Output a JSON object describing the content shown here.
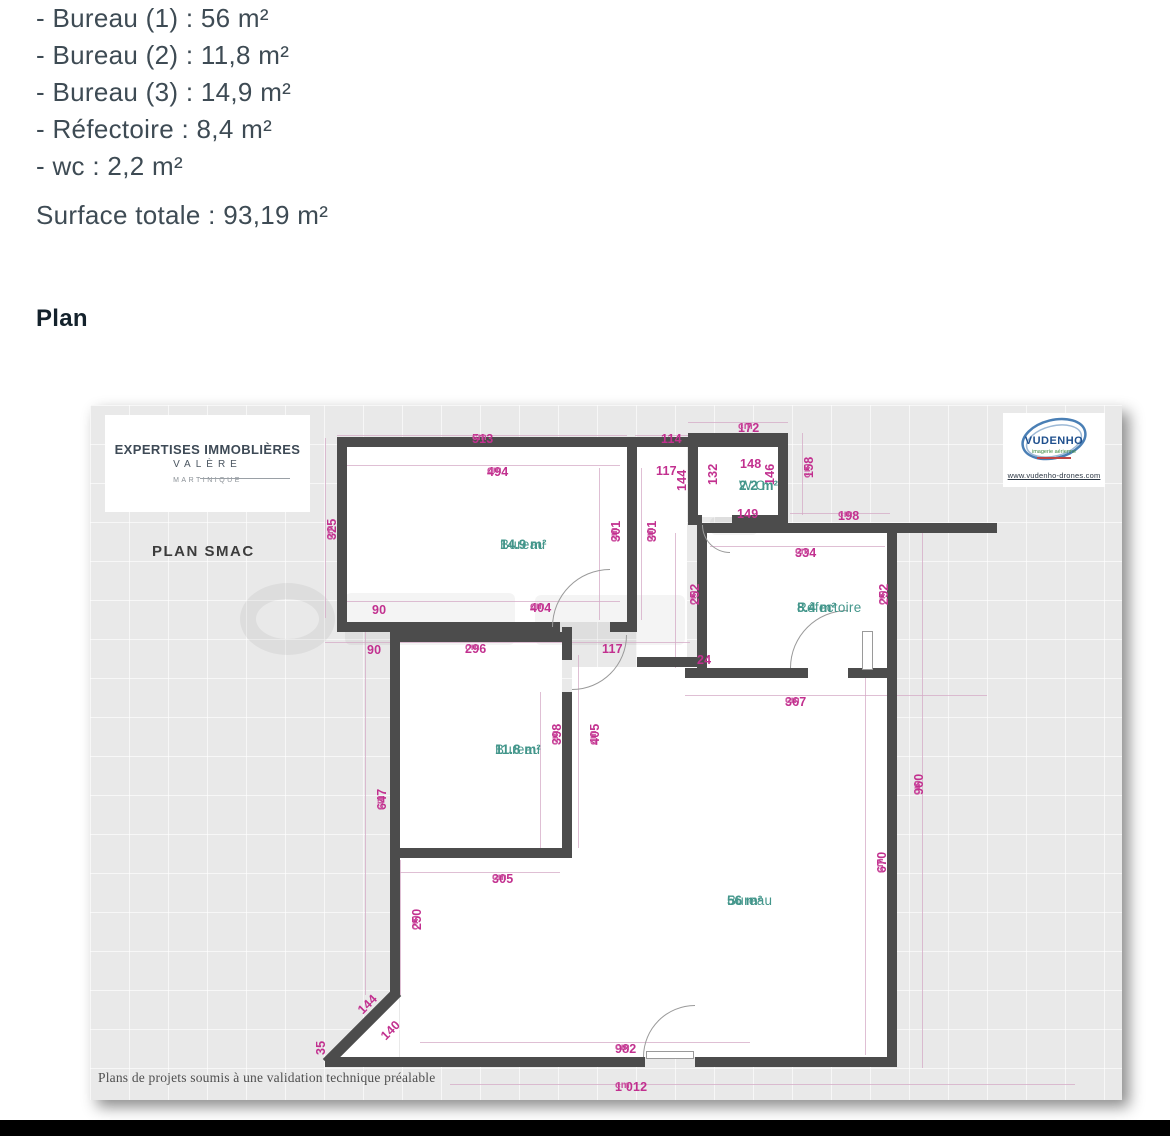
{
  "document": {
    "area_list": [
      "- Bureau (1) : 56 m²",
      "- Bureau (2) : 11,8 m²",
      "- Bureau (3) : 14,9 m²",
      "- Réfectoire : 8,4 m²",
      "- wc : 2,2 m²"
    ],
    "surface_total": "Surface totale : 93,19 m²",
    "plan_heading": "Plan"
  },
  "plan": {
    "agency": {
      "line1": "EXPERTISES IMMOBLIÈRES",
      "line2": "VALÈRE",
      "line3": "MARTINIQUE"
    },
    "plan_title": "PLAN SMAC",
    "vendor": {
      "name": "VUDENHO",
      "tagline": "imagerie aérienne",
      "url": "www.vudenho-drones.com"
    },
    "ceiling_note": "H. sous plafond  280cm",
    "footer_note": "Plans de projets soumis à une validation technique préalable",
    "colors": {
      "dimension": "#c2308f",
      "room": "#43968b",
      "wall": "#4c4c4c"
    },
    "white_areas": [
      {
        "x": 257,
        "y": 42,
        "w": 280,
        "h": 175
      },
      {
        "x": 547,
        "y": 42,
        "w": 50,
        "h": 210
      },
      {
        "x": 608,
        "y": 36,
        "w": 80,
        "h": 76
      },
      {
        "x": 617,
        "y": 128,
        "w": 180,
        "h": 137
      },
      {
        "x": 310,
        "y": 237,
        "w": 162,
        "h": 216
      },
      {
        "x": 310,
        "y": 453,
        "w": 180,
        "h": 199
      },
      {
        "x": 482,
        "y": 262,
        "w": 315,
        "h": 390
      },
      {
        "x": 547,
        "y": 252,
        "w": 60,
        "h": 20
      }
    ],
    "triangle": {
      "x": 243,
      "y": 587,
      "w": 66,
      "h": 67
    },
    "watermarks": [
      {
        "x": 150,
        "y": 178,
        "w": 95,
        "h": 72,
        "ring": true
      },
      {
        "x": 255,
        "y": 188,
        "w": 170,
        "h": 52,
        "ring": false
      },
      {
        "x": 445,
        "y": 190,
        "w": 150,
        "h": 50,
        "ring": false
      },
      {
        "x": 620,
        "y": 112,
        "w": 48,
        "h": 18,
        "ring": false
      }
    ],
    "lines": [
      {
        "x": 247,
        "y": 30,
        "w": 290,
        "h": 1
      },
      {
        "x": 545,
        "y": 30,
        "w": 53,
        "h": 1
      },
      {
        "x": 598,
        "y": 17,
        "w": 100,
        "h": 1
      },
      {
        "x": 255,
        "y": 60,
        "w": 275,
        "h": 1
      },
      {
        "x": 255,
        "y": 196,
        "w": 275,
        "h": 1
      },
      {
        "x": 235,
        "y": 237,
        "w": 365,
        "h": 1
      },
      {
        "x": 620,
        "y": 141,
        "w": 175,
        "h": 1
      },
      {
        "x": 700,
        "y": 108,
        "w": 100,
        "h": 1
      },
      {
        "x": 595,
        "y": 290,
        "w": 302,
        "h": 1
      },
      {
        "x": 300,
        "y": 467,
        "w": 170,
        "h": 1
      },
      {
        "x": 330,
        "y": 637,
        "w": 330,
        "h": 1
      },
      {
        "x": 360,
        "y": 679,
        "w": 625,
        "h": 1
      },
      {
        "x": 235,
        "y": 33,
        "w": 1,
        "h": 180
      },
      {
        "x": 509,
        "y": 63,
        "w": 1,
        "h": 152
      },
      {
        "x": 551,
        "y": 63,
        "w": 1,
        "h": 152
      },
      {
        "x": 712,
        "y": 28,
        "w": 1,
        "h": 82
      },
      {
        "x": 585,
        "y": 128,
        "w": 1,
        "h": 135
      },
      {
        "x": 800,
        "y": 128,
        "w": 1,
        "h": 135
      },
      {
        "x": 450,
        "y": 287,
        "w": 1,
        "h": 156
      },
      {
        "x": 488,
        "y": 250,
        "w": 1,
        "h": 193
      },
      {
        "x": 275,
        "y": 220,
        "w": 1,
        "h": 370
      },
      {
        "x": 310,
        "y": 455,
        "w": 1,
        "h": 135
      },
      {
        "x": 832,
        "y": 118,
        "w": 1,
        "h": 545
      },
      {
        "x": 775,
        "y": 255,
        "w": 1,
        "h": 395
      }
    ],
    "walls": [
      {
        "x": 247,
        "y": 32,
        "w": 451,
        "h": 10
      },
      {
        "x": 598,
        "y": 28,
        "w": 100,
        "h": 10
      },
      {
        "x": 598,
        "y": 28,
        "w": 10,
        "h": 92
      },
      {
        "x": 688,
        "y": 28,
        "w": 10,
        "h": 92
      },
      {
        "x": 598,
        "y": 110,
        "w": 14,
        "h": 10
      },
      {
        "x": 642,
        "y": 110,
        "w": 56,
        "h": 10
      },
      {
        "x": 247,
        "y": 32,
        "w": 10,
        "h": 195
      },
      {
        "x": 247,
        "y": 217,
        "w": 223,
        "h": 10
      },
      {
        "x": 520,
        "y": 217,
        "w": 27,
        "h": 10
      },
      {
        "x": 537,
        "y": 42,
        "w": 10,
        "h": 185
      },
      {
        "x": 607,
        "y": 118,
        "w": 300,
        "h": 10
      },
      {
        "x": 607,
        "y": 118,
        "w": 10,
        "h": 155
      },
      {
        "x": 595,
        "y": 263,
        "w": 123,
        "h": 10
      },
      {
        "x": 758,
        "y": 263,
        "w": 49,
        "h": 10
      },
      {
        "x": 797,
        "y": 118,
        "w": 10,
        "h": 544
      },
      {
        "x": 300,
        "y": 227,
        "w": 172,
        "h": 10
      },
      {
        "x": 472,
        "y": 222,
        "w": 10,
        "h": 33
      },
      {
        "x": 547,
        "y": 252,
        "w": 70,
        "h": 10
      },
      {
        "x": 472,
        "y": 287,
        "w": 10,
        "h": 156
      },
      {
        "x": 300,
        "y": 443,
        "w": 182,
        "h": 10
      },
      {
        "x": 300,
        "y": 217,
        "w": 10,
        "h": 373
      },
      {
        "x": 222,
        "y": 617,
        "w": 100,
        "h": 11,
        "r": -45
      },
      {
        "x": 235,
        "y": 652,
        "w": 320,
        "h": 10
      },
      {
        "x": 605,
        "y": 652,
        "w": 192,
        "h": 10
      }
    ],
    "doors": [
      {
        "x": 462,
        "y": 164,
        "w": 58,
        "h": 58,
        "c": "tl"
      },
      {
        "x": 482,
        "y": 230,
        "w": 55,
        "h": 55,
        "c": "br"
      },
      {
        "x": 700,
        "y": 205,
        "w": 58,
        "h": 58,
        "c": "tl"
      },
      {
        "x": 612,
        "y": 120,
        "w": 28,
        "h": 28,
        "c": "bl"
      },
      {
        "x": 553,
        "y": 600,
        "w": 52,
        "h": 52,
        "c": "tl"
      }
    ],
    "leaves": [
      {
        "x": 772,
        "y": 226,
        "w": 11,
        "h": 39
      },
      {
        "x": 556,
        "y": 646,
        "w": 48,
        "h": 8
      }
    ],
    "dims": [
      {
        "t": "513",
        "u": "cm",
        "x": 382,
        "y": 27,
        "r": 0
      },
      {
        "t": "114",
        "u": "",
        "x": 571,
        "y": 27,
        "r": 0
      },
      {
        "t": "172",
        "u": "cm",
        "x": 648,
        "y": 16,
        "r": 0
      },
      {
        "t": "494",
        "u": "cm",
        "x": 397,
        "y": 60,
        "r": 0
      },
      {
        "t": "117",
        "u": "",
        "x": 566,
        "y": 59,
        "r": 0
      },
      {
        "t": "144",
        "u": "",
        "x": 585,
        "y": 86,
        "r": -90
      },
      {
        "t": "148",
        "u": "",
        "x": 650,
        "y": 52,
        "r": 0
      },
      {
        "t": "132",
        "u": "",
        "x": 616,
        "y": 80,
        "r": -90
      },
      {
        "t": "146",
        "u": "",
        "x": 673,
        "y": 80,
        "r": -90
      },
      {
        "t": "149",
        "u": "",
        "x": 647,
        "y": 102,
        "r": 0
      },
      {
        "t": "158",
        "u": "cm",
        "x": 712,
        "y": 73,
        "r": -90
      },
      {
        "t": "198",
        "u": "cm",
        "x": 748,
        "y": 104,
        "r": 0
      },
      {
        "t": "325",
        "u": "cm",
        "x": 235,
        "y": 135,
        "r": -90
      },
      {
        "t": "301",
        "u": "cm",
        "x": 519,
        "y": 137,
        "r": -90
      },
      {
        "t": "301",
        "u": "cm",
        "x": 555,
        "y": 137,
        "r": -90
      },
      {
        "t": "90",
        "u": "",
        "x": 282,
        "y": 198,
        "r": 0
      },
      {
        "t": "404",
        "u": "cm",
        "x": 440,
        "y": 196,
        "r": 0
      },
      {
        "t": "90",
        "u": "",
        "x": 277,
        "y": 238,
        "r": 0
      },
      {
        "t": "296",
        "u": "cm",
        "x": 375,
        "y": 237,
        "r": 0
      },
      {
        "t": "117",
        "u": "",
        "x": 512,
        "y": 237,
        "r": 0
      },
      {
        "t": "334",
        "u": "cm",
        "x": 705,
        "y": 141,
        "r": 0
      },
      {
        "t": "252",
        "u": "cm",
        "x": 598,
        "y": 200,
        "r": -90
      },
      {
        "t": "252",
        "u": "cm",
        "x": 787,
        "y": 200,
        "r": -90
      },
      {
        "t": "24",
        "u": "",
        "x": 607,
        "y": 248,
        "r": 0
      },
      {
        "t": "367",
        "u": "cm",
        "x": 695,
        "y": 290,
        "r": 0
      },
      {
        "t": "398",
        "u": "cm",
        "x": 460,
        "y": 340,
        "r": -90
      },
      {
        "t": "405",
        "u": "cm",
        "x": 498,
        "y": 340,
        "r": -90
      },
      {
        "t": "647",
        "u": "cm",
        "x": 285,
        "y": 405,
        "r": -90
      },
      {
        "t": "305",
        "u": "cm",
        "x": 402,
        "y": 467,
        "r": 0
      },
      {
        "t": "250",
        "u": "cm",
        "x": 320,
        "y": 525,
        "r": -90
      },
      {
        "t": "960",
        "u": "cm",
        "x": 822,
        "y": 390,
        "r": -90
      },
      {
        "t": "670",
        "u": "cm",
        "x": 785,
        "y": 468,
        "r": -90
      },
      {
        "t": "144",
        "u": "",
        "x": 265,
        "y": 602,
        "r": -45
      },
      {
        "t": "140",
        "u": "",
        "x": 288,
        "y": 628,
        "r": -45
      },
      {
        "t": "35",
        "u": "",
        "x": 224,
        "y": 650,
        "r": -90
      },
      {
        "t": "982",
        "u": "cm",
        "x": 525,
        "y": 637,
        "r": 0
      },
      {
        "t": "1 012",
        "u": "cm",
        "x": 525,
        "y": 675,
        "r": 0
      }
    ],
    "rooms": [
      {
        "name": "Bureau",
        "area": "14.9 m²",
        "x": 410,
        "y": 132
      },
      {
        "name": "W.C.",
        "area": "2.2 m²",
        "x": 649,
        "y": 73
      },
      {
        "name": "Réfectoire",
        "area": "8.4 m²",
        "x": 707,
        "y": 195
      },
      {
        "name": "Bureau",
        "area": "11.8 m²",
        "x": 405,
        "y": 337
      },
      {
        "name": "Bureau",
        "area": "56 m²",
        "x": 637,
        "y": 488
      }
    ],
    "ceiling_note_pos": {
      "x": 425,
      "y": 47
    }
  }
}
